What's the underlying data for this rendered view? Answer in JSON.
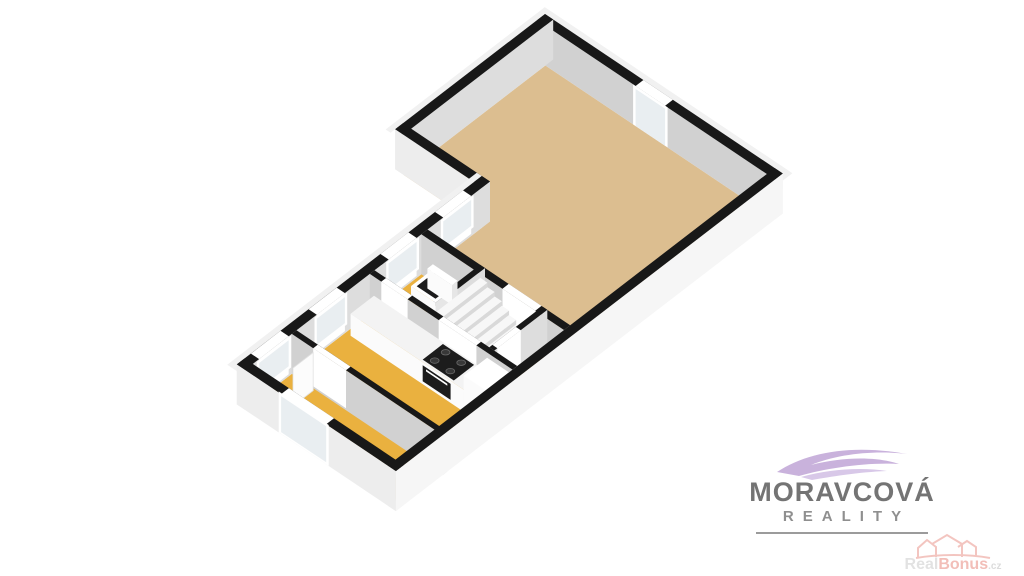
{
  "page": {
    "background": "#ffffff"
  },
  "logo": {
    "title": "MORAVCOVÁ",
    "subtitle": "REALITY"
  },
  "watermark": {
    "real": "Real",
    "bonus": "Bonus",
    "tld": ".cz"
  },
  "colors": {
    "wallTop": "#181818",
    "strip": "#f1f1f1",
    "extU": "#f6f6f6",
    "extV": "#ededed",
    "intU": "#dddddd",
    "intV": "#d1d1d1",
    "glass": "#e9eef1",
    "white": "#ffffff",
    "floorTan": "#dcbe90",
    "floorOrange": "#eab13f",
    "floorHall": "#efefef",
    "stairTop": "#f7f7f7",
    "stairRiser": "#d9d9d9",
    "stairSide": "#ececec",
    "counterTop": "#f3f3f3",
    "counterFace": "#fbfbfb",
    "counterSide": "#e6e6e6",
    "dark": "#1c1c1c",
    "doorLeaf": "#fcfcfc",
    "burner": "#383838",
    "burnerRing": "#6a6a6a",
    "logoPurple1": "#c9b2dc",
    "logoPurple2": "#d8c8e8",
    "wmRed": "#f2bcb6"
  },
  "plan": {
    "origin": [
      545,
      54
    ],
    "basis": {
      "u": [
        0.82,
        0.55
      ],
      "v": [
        -0.78,
        0.6
      ]
    },
    "wall_height": 40,
    "scene": [
      {
        "t": "floor",
        "name": "floor-living-room",
        "fill": "floorTan",
        "poly": [
          [
            10,
            10
          ],
          [
            280,
            10
          ],
          [
            280,
            270
          ],
          [
            106,
            270
          ],
          [
            106,
            192
          ],
          [
            10,
            192
          ]
        ]
      },
      {
        "t": "floor",
        "name": "floor-hall",
        "fill": "floorHall",
        "poly": [
          [
            106,
            262
          ],
          [
            280,
            262
          ],
          [
            280,
            340
          ],
          [
            106,
            340
          ]
        ]
      },
      {
        "t": "floor",
        "name": "floor-entry",
        "fill": "floorOrange",
        "poly": [
          [
            248,
            266
          ],
          [
            280,
            266
          ],
          [
            280,
            334
          ],
          [
            248,
            334
          ]
        ]
      },
      {
        "t": "floor",
        "name": "floor-wc",
        "fill": "floorOrange",
        "poly": [
          [
            106,
            266
          ],
          [
            172,
            266
          ],
          [
            172,
            332
          ],
          [
            106,
            332
          ]
        ]
      },
      {
        "t": "floor",
        "name": "floor-kitchen",
        "fill": "floorOrange",
        "poly": [
          [
            106,
            334
          ],
          [
            280,
            334
          ],
          [
            280,
            434
          ],
          [
            106,
            434
          ]
        ]
      },
      {
        "t": "floor",
        "name": "floor-bedroom",
        "fill": "floorOrange",
        "poly": [
          [
            106,
            430
          ],
          [
            280,
            430
          ],
          [
            280,
            486
          ],
          [
            106,
            486
          ]
        ]
      },
      {
        "t": "wall",
        "name": "wall-ne-exterior",
        "u": [
          0,
          290
        ],
        "v": [
          0,
          10
        ],
        "ext": "-v",
        "faceU": "extU",
        "faceV": "intV",
        "gaps": [
          {
            "axis": "u",
            "a": [
              120,
              156
            ]
          }
        ]
      },
      {
        "t": "door",
        "name": "entry-door",
        "plane": "v",
        "at": 10,
        "a": [
          120,
          156
        ],
        "z": [
          0,
          37
        ],
        "frame": 3
      },
      {
        "t": "wall",
        "name": "wall-nw-upper-exterior",
        "u": [
          0,
          10
        ],
        "v": [
          0,
          192
        ],
        "ext": "-u",
        "faceU": "intU",
        "faceV": "extV"
      },
      {
        "t": "wall",
        "name": "wall-notch-exterior",
        "u": [
          0,
          106
        ],
        "v": [
          182,
          192
        ],
        "faceU": "intU",
        "faceV": "extV"
      },
      {
        "t": "wall",
        "name": "wall-nw-lower-exterior",
        "u": [
          96,
          106
        ],
        "v": [
          182,
          496
        ],
        "ext": "-u",
        "faceU": "intU",
        "faceV": "extV",
        "gaps": [
          {
            "axis": "v",
            "a": [
              206,
              242
            ]
          },
          {
            "axis": "v",
            "a": [
              276,
              312
            ]
          },
          {
            "axis": "v",
            "a": [
              368,
              404
            ]
          },
          {
            "axis": "v",
            "a": [
              440,
              478
            ]
          }
        ]
      },
      {
        "t": "window",
        "name": "window-hall",
        "plane": "u",
        "at": 106,
        "a": [
          206,
          242
        ],
        "z": [
          10,
          36
        ]
      },
      {
        "t": "window",
        "name": "window-wc",
        "plane": "u",
        "at": 106,
        "a": [
          276,
          312
        ],
        "z": [
          10,
          36
        ]
      },
      {
        "t": "window",
        "name": "window-kitchen",
        "plane": "u",
        "at": 106,
        "a": [
          368,
          404
        ],
        "z": [
          10,
          36
        ]
      },
      {
        "t": "window",
        "name": "window-bedroom-nw",
        "plane": "u",
        "at": 106,
        "a": [
          440,
          478
        ],
        "z": [
          10,
          36
        ]
      },
      {
        "t": "wall",
        "name": "wall-living-hall",
        "u": [
          106,
          280
        ],
        "v": [
          262,
          270
        ],
        "faceU": "intU",
        "faceV": "intV",
        "gaps": [
          {
            "axis": "u",
            "a": [
              205,
              245
            ]
          }
        ]
      },
      {
        "t": "wall",
        "name": "wall-wc-stairs",
        "u": [
          170,
          176
        ],
        "v": [
          262,
          330
        ],
        "faceU": "intU",
        "faceV": "intV"
      },
      {
        "t": "box",
        "name": "toilet",
        "u": [
          122,
          152
        ],
        "v": [
          272,
          300
        ],
        "h": 15,
        "top": "white",
        "faceU": "counterSide",
        "faceV": "counterFace"
      },
      {
        "t": "toprect",
        "name": "toilet-lid",
        "u": [
          126,
          149
        ],
        "v": [
          275,
          297
        ],
        "z": 15.3,
        "fill": "dark"
      },
      {
        "t": "box",
        "name": "toilet-cistern",
        "u": [
          122,
          152
        ],
        "v": [
          272,
          279
        ],
        "h": 20,
        "top": "white",
        "faceU": "counterSide",
        "faceV": "counterFace"
      },
      {
        "t": "stairs",
        "name": "staircase",
        "u": [
          178,
          248
        ],
        "v": [
          270,
          326
        ],
        "steps": 8,
        "ztop": 36
      },
      {
        "t": "wall",
        "name": "wall-stairs-entry",
        "u": [
          246,
          252
        ],
        "v": [
          262,
          330
        ],
        "faceU": "intU",
        "faceV": "intV",
        "gaps": [
          {
            "axis": "v",
            "a": [
              296,
              326
            ]
          }
        ]
      },
      {
        "t": "wall",
        "name": "wall-hall-kitchen",
        "u": [
          106,
          280
        ],
        "v": [
          330,
          336
        ],
        "faceU": "intU",
        "faceV": "intV",
        "gaps": [
          {
            "axis": "u",
            "a": [
              120,
              152
            ]
          },
          {
            "axis": "u",
            "a": [
              190,
              236
            ]
          }
        ]
      },
      {
        "t": "box",
        "name": "kitchen-counter",
        "u": [
          112,
          278
        ],
        "v": [
          337,
          367
        ],
        "h": 22,
        "top": "counterTop",
        "faceU": "counterSide",
        "faceV": "counterFace"
      },
      {
        "t": "toprect",
        "name": "cooktop",
        "u": [
          198,
          236
        ],
        "v": [
          339,
          365
        ],
        "z": 22.3,
        "fill": "dark"
      },
      {
        "t": "burners",
        "name": "cooktop-burners",
        "r": 4.4,
        "centers": [
          [
            207,
            345
          ],
          [
            226,
            345
          ],
          [
            207,
            359
          ],
          [
            226,
            359
          ]
        ]
      },
      {
        "t": "facerect",
        "name": "oven",
        "plane": "v",
        "at": 367,
        "a": [
          200,
          234
        ],
        "z": [
          3,
          19
        ],
        "fill": "dark"
      },
      {
        "t": "facerect",
        "name": "oven-handle",
        "plane": "v",
        "at": 367,
        "a": [
          204,
          230
        ],
        "z": [
          15,
          17
        ],
        "fill": "white"
      },
      {
        "t": "box",
        "name": "fridge",
        "u": [
          250,
          278
        ],
        "v": [
          337,
          367
        ],
        "h": 36,
        "top": "white",
        "faceU": "counterSide",
        "faceV": "counterFace"
      },
      {
        "t": "wall",
        "name": "wall-kitchen-bedroom",
        "u": [
          106,
          290
        ],
        "v": [
          430,
          436
        ],
        "faceU": "intU",
        "faceV": "intV",
        "gaps": [
          {
            "axis": "u",
            "a": [
              132,
              172
            ]
          }
        ]
      },
      {
        "t": "facerect",
        "name": "bedroom-door-leaf",
        "plane": "u",
        "at": 134,
        "a": [
          438,
          464
        ],
        "z": [
          0,
          38
        ],
        "fill": "doorLeaf",
        "stroke": "#e2e2e2"
      },
      {
        "t": "wall",
        "name": "wall-se-exterior",
        "u": [
          280,
          290
        ],
        "v": [
          0,
          496
        ],
        "ext": "+u",
        "faceU": "extU",
        "faceV": "extV"
      },
      {
        "t": "wall",
        "name": "wall-sw-exterior",
        "u": [
          96,
          290
        ],
        "v": [
          486,
          496
        ],
        "ext": "+v",
        "faceU": "extU",
        "faceV": "extV",
        "gaps": [
          {
            "axis": "u",
            "a": [
              150,
              205
            ]
          }
        ]
      },
      {
        "t": "window",
        "name": "window-bedroom-sw",
        "plane": "v",
        "at": 496,
        "a": [
          150,
          205
        ],
        "z": [
          2,
          38
        ]
      }
    ]
  }
}
